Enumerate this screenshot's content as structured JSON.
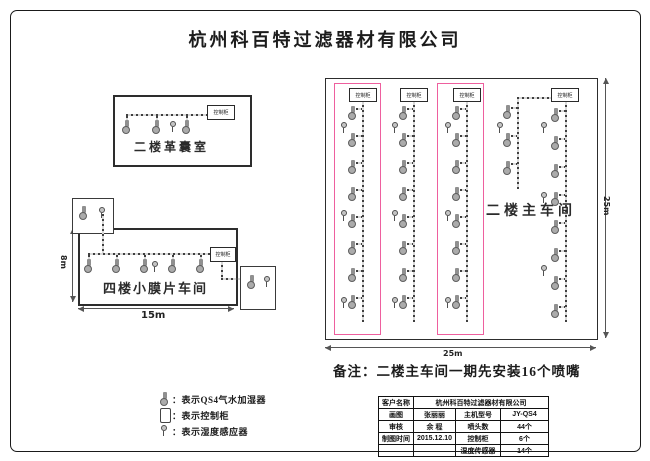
{
  "title": "杭州科百特过滤器材有限公司",
  "labels": {
    "control_cabinet": "控制柜"
  },
  "rooms": {
    "bladder_room": {
      "name": "二楼革囊室"
    },
    "membrane_room": {
      "name": "四楼小膜片车间",
      "width": "15m",
      "height": "8m"
    },
    "main_workshop": {
      "name": "二楼主车间",
      "width": "25m",
      "height": "25m"
    }
  },
  "note": "备注：二楼主车间一期先安装16个喷嘴",
  "legend": [
    {
      "icon": "humidifier-nozzle-icon",
      "label": "：表示QS4气水加湿器"
    },
    {
      "icon": "control-cabinet-icon",
      "label": "：表示控制柜"
    },
    {
      "icon": "humidity-sensor-icon",
      "label": "：表示湿度感应器"
    }
  ],
  "title_block": {
    "customer_label": "客户名称",
    "customer_value": "杭州科百特过滤器材有限公司",
    "rows": [
      {
        "c1": "画图",
        "c2": "张丽丽",
        "c3": "主机型号",
        "c4": "JY-QS4"
      },
      {
        "c1": "审核",
        "c2": "余  程",
        "c3": "喷头数",
        "c4": "44个"
      },
      {
        "c1": "制图时间",
        "c2": "2015.12.10",
        "c3": "控制柜",
        "c4": "6个"
      },
      {
        "c1": "",
        "c2": "",
        "c3": "湿度传感器",
        "c4": "14个"
      }
    ]
  },
  "colors": {
    "highlight_pink": "#ee5f9e"
  }
}
